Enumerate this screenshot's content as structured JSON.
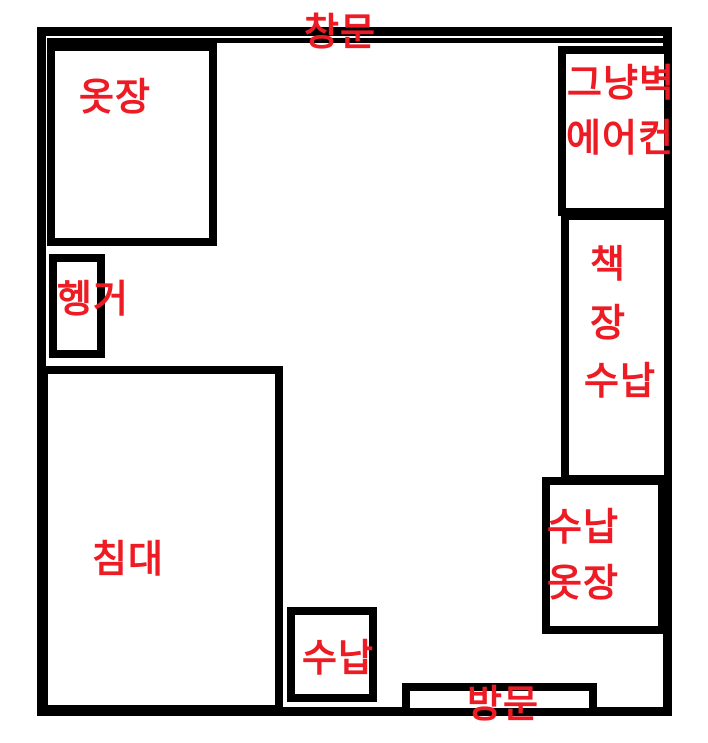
{
  "colors": {
    "wall": "#000000",
    "label_red": "#ed1c24",
    "background": "#ffffff"
  },
  "floorplan": {
    "window_label": "창문",
    "wardrobe_label": "옷장",
    "hanger_label": "헹거",
    "bed_label": "침대",
    "wall_aircon_label_line1": "그냥벽",
    "wall_aircon_label_line2": "에어컨",
    "bookshelf_label_line1": "책",
    "bookshelf_label_line2": "장",
    "bookshelf_label_line3": "수납",
    "storage_wardrobe_label_line1": "수납",
    "storage_wardrobe_label_line2": "옷장",
    "storage_label": "수납",
    "door_label": "방문"
  }
}
